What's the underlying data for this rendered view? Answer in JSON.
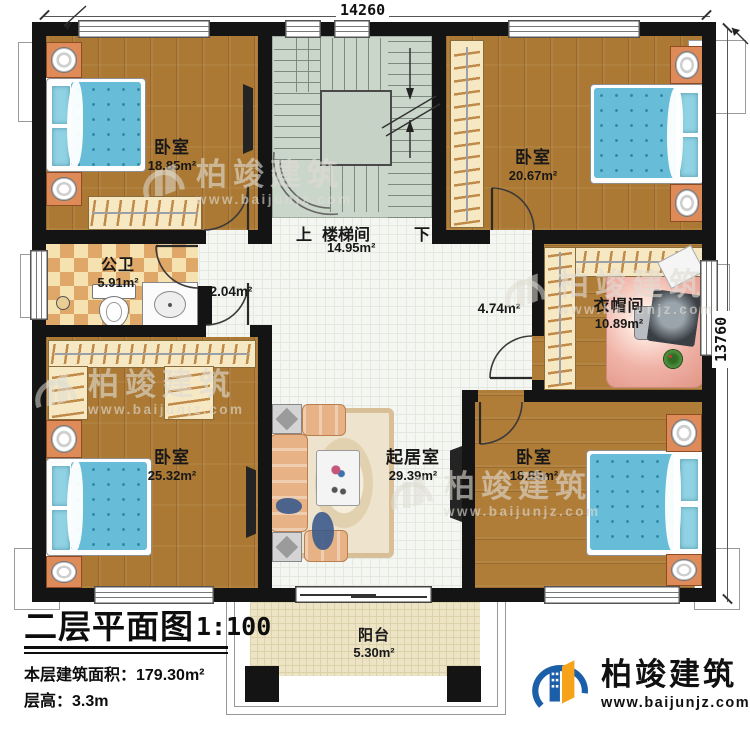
{
  "plan": {
    "dimensions": {
      "width": "14260",
      "height": "13760"
    },
    "stairs": {
      "up_label": "上",
      "down_label": "下"
    },
    "rooms": {
      "bedroom_tl": {
        "label": "卧室",
        "area": "18.85m²"
      },
      "bedroom_tr": {
        "label": "卧室",
        "area": "20.67m²"
      },
      "stairwell": {
        "label": "楼梯间",
        "area": "14.95m²"
      },
      "bathroom": {
        "label": "公卫",
        "area": "5.91m²"
      },
      "hallway": {
        "area": "2.04m²"
      },
      "corridor": {
        "area": "4.74m²"
      },
      "cloakroom": {
        "label": "衣帽间",
        "area": "10.89m²"
      },
      "bedroom_bl": {
        "label": "卧室",
        "area": "25.32m²"
      },
      "living_room": {
        "label": "起居室",
        "area": "29.39m²"
      },
      "bedroom_br": {
        "label": "卧室",
        "area": "18.85m²"
      },
      "balcony": {
        "label": "阳台",
        "area": "5.30m²"
      }
    }
  },
  "title_block": {
    "title": "二层平面图",
    "scale": "1:100",
    "floor_area": "本层建筑面积：179.30m²",
    "floor_height": "层高：3.3m"
  },
  "branding": {
    "logo_name": "柏竣建筑",
    "logo_url": "www.baijunjz.com",
    "watermark_name": "柏竣建筑",
    "watermark_url": "www.baijunjz.com"
  },
  "colors": {
    "wall": "#141414",
    "wood_floor": "#ab7934",
    "tile_floor": "#f4f6f1",
    "stair_floor": "#cbd6ca",
    "bath_tile_light": "#f6e2b0",
    "bath_tile_dark": "#dfa868",
    "balcony_floor": "#ece4c5",
    "bed_blue": "#67bcd8",
    "furniture_orange": "#df8b59",
    "logo_blue": "#1b5fa8",
    "logo_orange": "#f7a21b"
  }
}
